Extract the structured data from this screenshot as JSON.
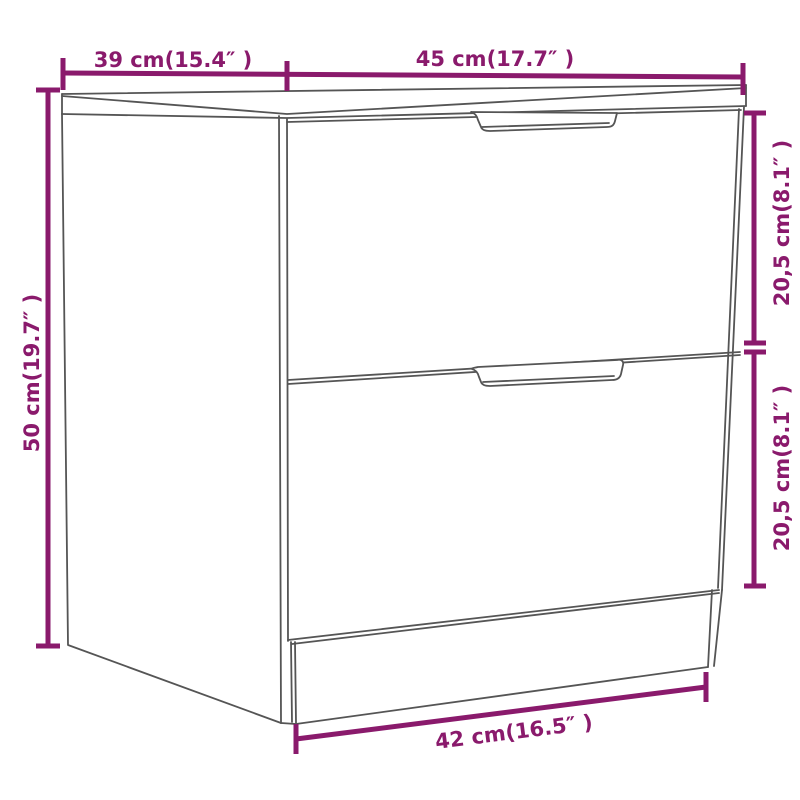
{
  "diagram": {
    "type": "furniture-dimension-diagram",
    "subject": "bedside cabinet with two drawers",
    "background": "#ffffff",
    "accent_color": "#8a1a6c",
    "line_color": "#555555",
    "dimensions": {
      "depth_top": {
        "label": "39 cm(15.4″ )",
        "value_cm": "39",
        "value_inch": "15.4",
        "position": "top-left",
        "orientation": "horizontal"
      },
      "width_top": {
        "label": "45 cm(17.7″ )",
        "value_cm": "45",
        "value_inch": "17.7",
        "position": "top-right",
        "orientation": "horizontal"
      },
      "height_left": {
        "label": "50 cm(19.7″ )",
        "value_cm": "50",
        "value_inch": "19.7",
        "position": "left",
        "orientation": "vertical"
      },
      "drawer_top_height": {
        "label": "20,5 cm(8.1″ )",
        "value_cm": "20,5",
        "value_inch": "8.1",
        "position": "right-upper",
        "orientation": "vertical"
      },
      "drawer_bottom_height": {
        "label": "20,5 cm(8.1″ )",
        "value_cm": "20,5",
        "value_inch": "8.1",
        "position": "right-lower",
        "orientation": "vertical"
      },
      "base_width_bottom": {
        "label": "42 cm(16.5″ )",
        "value_cm": "42",
        "value_inch": "16.5",
        "position": "bottom",
        "orientation": "slanted"
      }
    }
  }
}
